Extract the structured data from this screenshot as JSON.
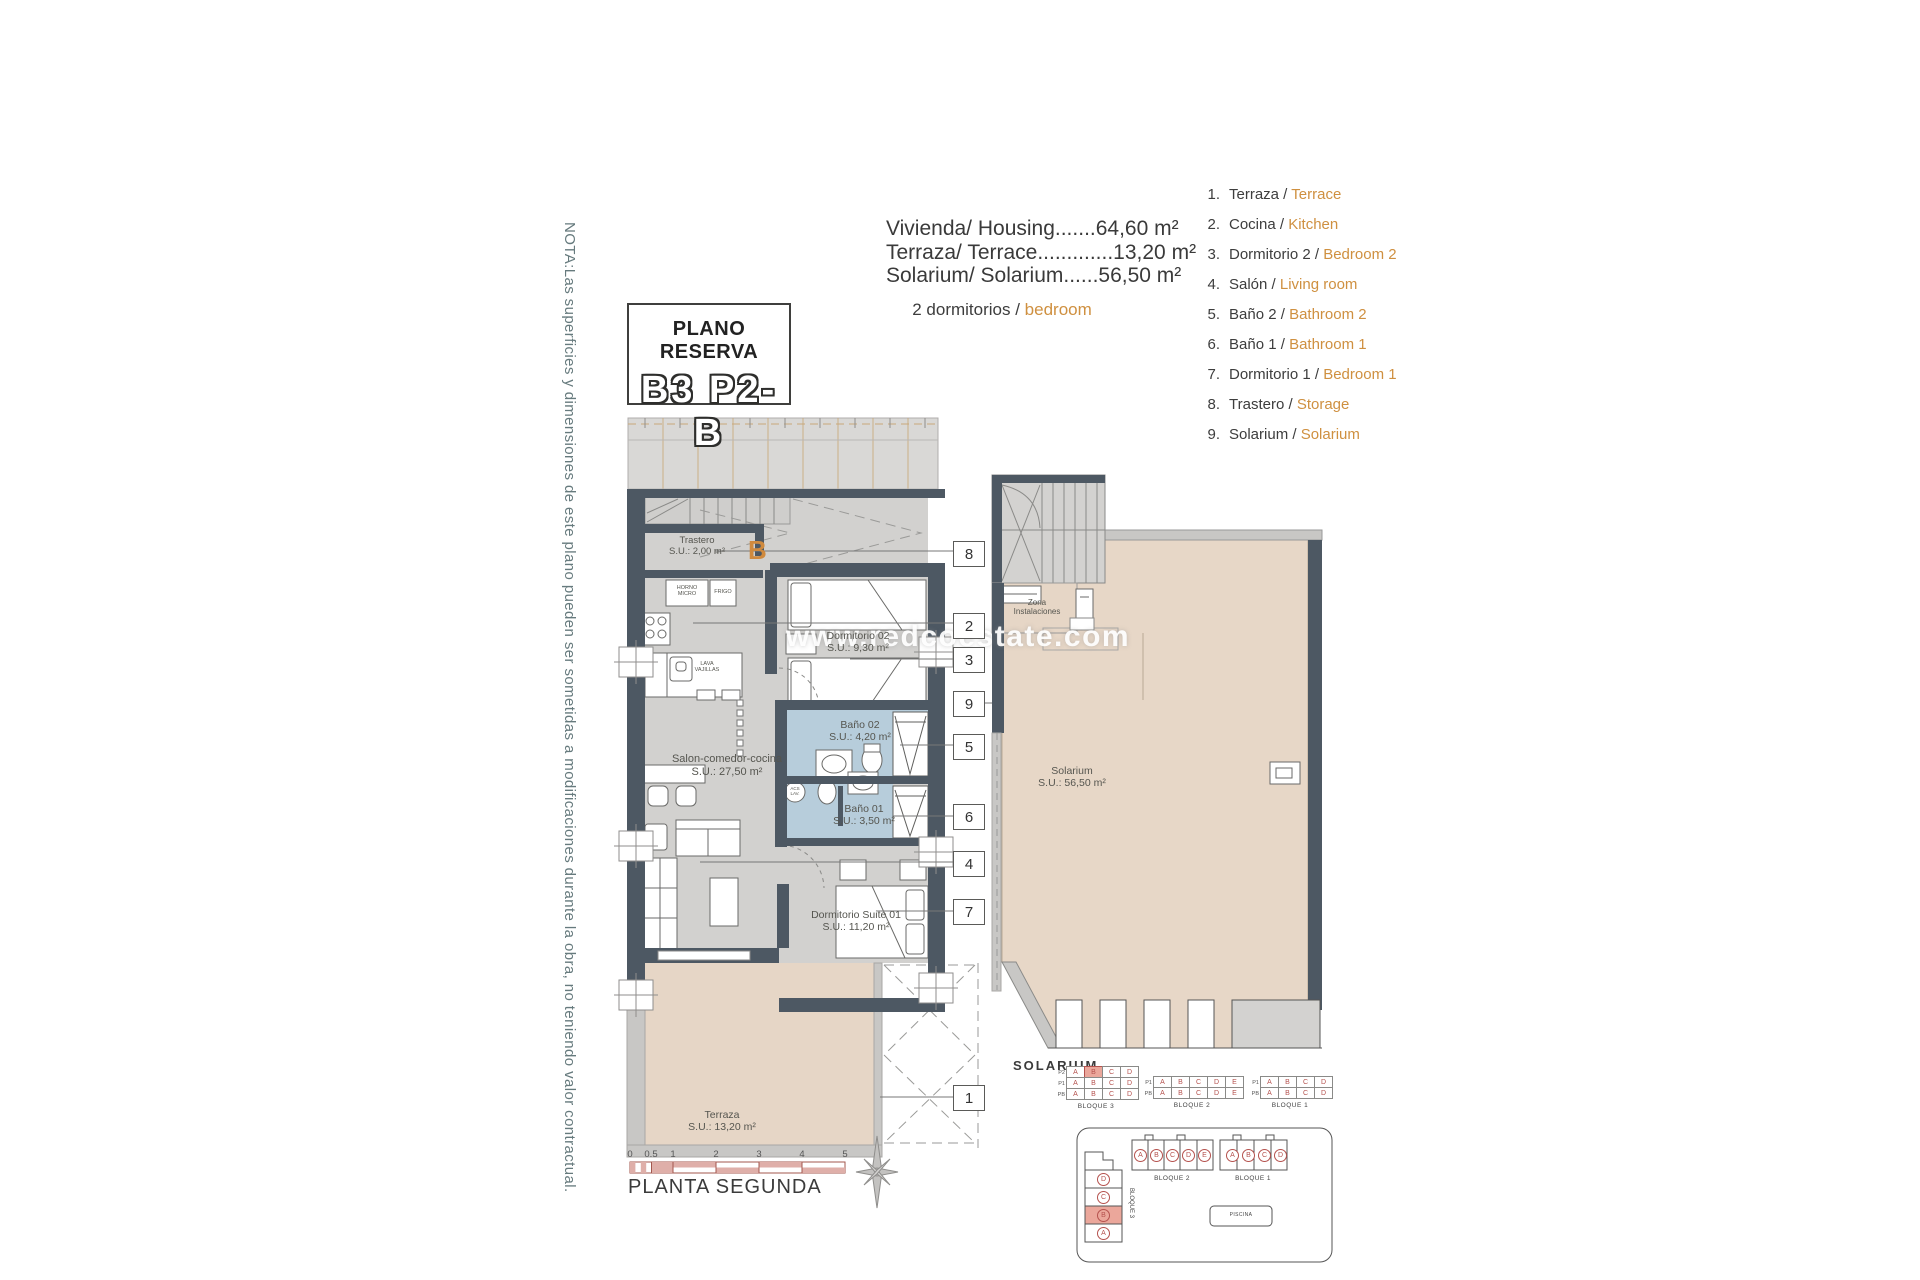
{
  "note": "NOTA:Las superficies y dimensiones de este plano pueden ser sometidas a modificaciones durante la obra, no teniendo valor contractual.",
  "reserve_box": {
    "title": "PLANO RESERVA",
    "code": "B3 P2-B"
  },
  "areas": [
    "Vivienda/ Housing.......64,60 m²",
    "Terraza/ Terrace.............13,20 m²",
    "Solarium/ Solarium......56,50 m²"
  ],
  "subtitle": {
    "es": "2 dormitorios /",
    "en": "bedroom"
  },
  "legend": [
    {
      "n": "1.",
      "es": "Terraza /",
      "en": "Terrace"
    },
    {
      "n": "2.",
      "es": "Cocina /",
      "en": "Kitchen"
    },
    {
      "n": "3.",
      "es": "Dormitorio 2 /",
      "en": "Bedroom 2"
    },
    {
      "n": "4.",
      "es": "Salón /",
      "en": "Living room"
    },
    {
      "n": "5.",
      "es": "Baño 2 /",
      "en": "Bathroom 2"
    },
    {
      "n": "6.",
      "es": "Baño 1 /",
      "en": "Bathroom 1"
    },
    {
      "n": "7.",
      "es": "Dormitorio 1 /",
      "en": "Bedroom 1"
    },
    {
      "n": "8.",
      "es": "Trastero /",
      "en": "Storage"
    },
    {
      "n": "9.",
      "es": "Solarium /",
      "en": "Solarium"
    }
  ],
  "watermark": "www.redcoestate.com",
  "rooms": {
    "trastero": {
      "l1": "Trastero",
      "l2": "S.U.: 2,00 m²"
    },
    "dorm2": {
      "l1": "Dormitorio 02",
      "l2": "S.U.: 9,30 m²"
    },
    "bano2": {
      "l1": "Baño 02",
      "l2": "S.U.: 4,20 m²"
    },
    "bano1": {
      "l1": "Baño 01",
      "l2": "S.U.: 3,50 m²"
    },
    "salon": {
      "l1": "Salon-comedor-cocina",
      "l2": "S.U.: 27,50 m²"
    },
    "suite": {
      "l1": "Dormitorio Suite 01",
      "l2": "S.U.: 11,20 m²"
    },
    "terraza": {
      "l1": "Terraza",
      "l2": "S.U.: 13,20 m²"
    },
    "solarium": {
      "l1": "Solarium",
      "l2": "S.U.: 56,50 m²"
    },
    "zona": {
      "l1": "Zona",
      "l2": "Instalaciones"
    }
  },
  "appliances": {
    "horno": "HORNO MICRO",
    "frigo": "FRIGO",
    "lava": "LAVA VAJILLAS",
    "acs": "ACS LAV.",
    "marker_b": "B"
  },
  "callouts": {
    "c1": "1",
    "c2": "2",
    "c3": "3",
    "c4": "4",
    "c5": "5",
    "c6": "6",
    "c7": "7",
    "c8": "8",
    "c9": "9"
  },
  "solarium_caption": "SOLARIUM",
  "plan_caption": "PLANTA SEGUNDA",
  "scale_ticks": [
    "0",
    "0.5",
    "1",
    "2",
    "3",
    "4",
    "5"
  ],
  "bloques": {
    "t3": {
      "caption": "BLOQUE 3",
      "rows": [
        {
          "label": "P2",
          "cells": [
            "A",
            "B",
            "C",
            "D"
          ]
        },
        {
          "label": "P1",
          "cells": [
            "A",
            "B",
            "C",
            "D"
          ]
        },
        {
          "label": "PB",
          "cells": [
            "A",
            "B",
            "C",
            "D"
          ]
        }
      ]
    },
    "t2": {
      "caption": "BLOQUE 2",
      "rows": [
        {
          "label": "P1",
          "cells": [
            "A",
            "B",
            "C",
            "D",
            "E"
          ]
        },
        {
          "label": "PB",
          "cells": [
            "A",
            "B",
            "C",
            "D",
            "E"
          ]
        }
      ]
    },
    "t1": {
      "caption": "BLOQUE 1",
      "rows": [
        {
          "label": "P1",
          "cells": [
            "A",
            "B",
            "C",
            "D"
          ]
        },
        {
          "label": "PB",
          "cells": [
            "A",
            "B",
            "C",
            "D"
          ]
        }
      ]
    },
    "site": {
      "b3": {
        "label": "BLOQUE 3",
        "units": [
          "D",
          "C",
          "B",
          "A"
        ]
      },
      "b2": {
        "label": "BLOQUE 2",
        "units": [
          "A",
          "B",
          "C",
          "D",
          "E"
        ]
      },
      "b1": {
        "label": "BLOQUE 1",
        "units": [
          "A",
          "B",
          "C",
          "D"
        ]
      },
      "pool": "PISCINA"
    }
  }
}
